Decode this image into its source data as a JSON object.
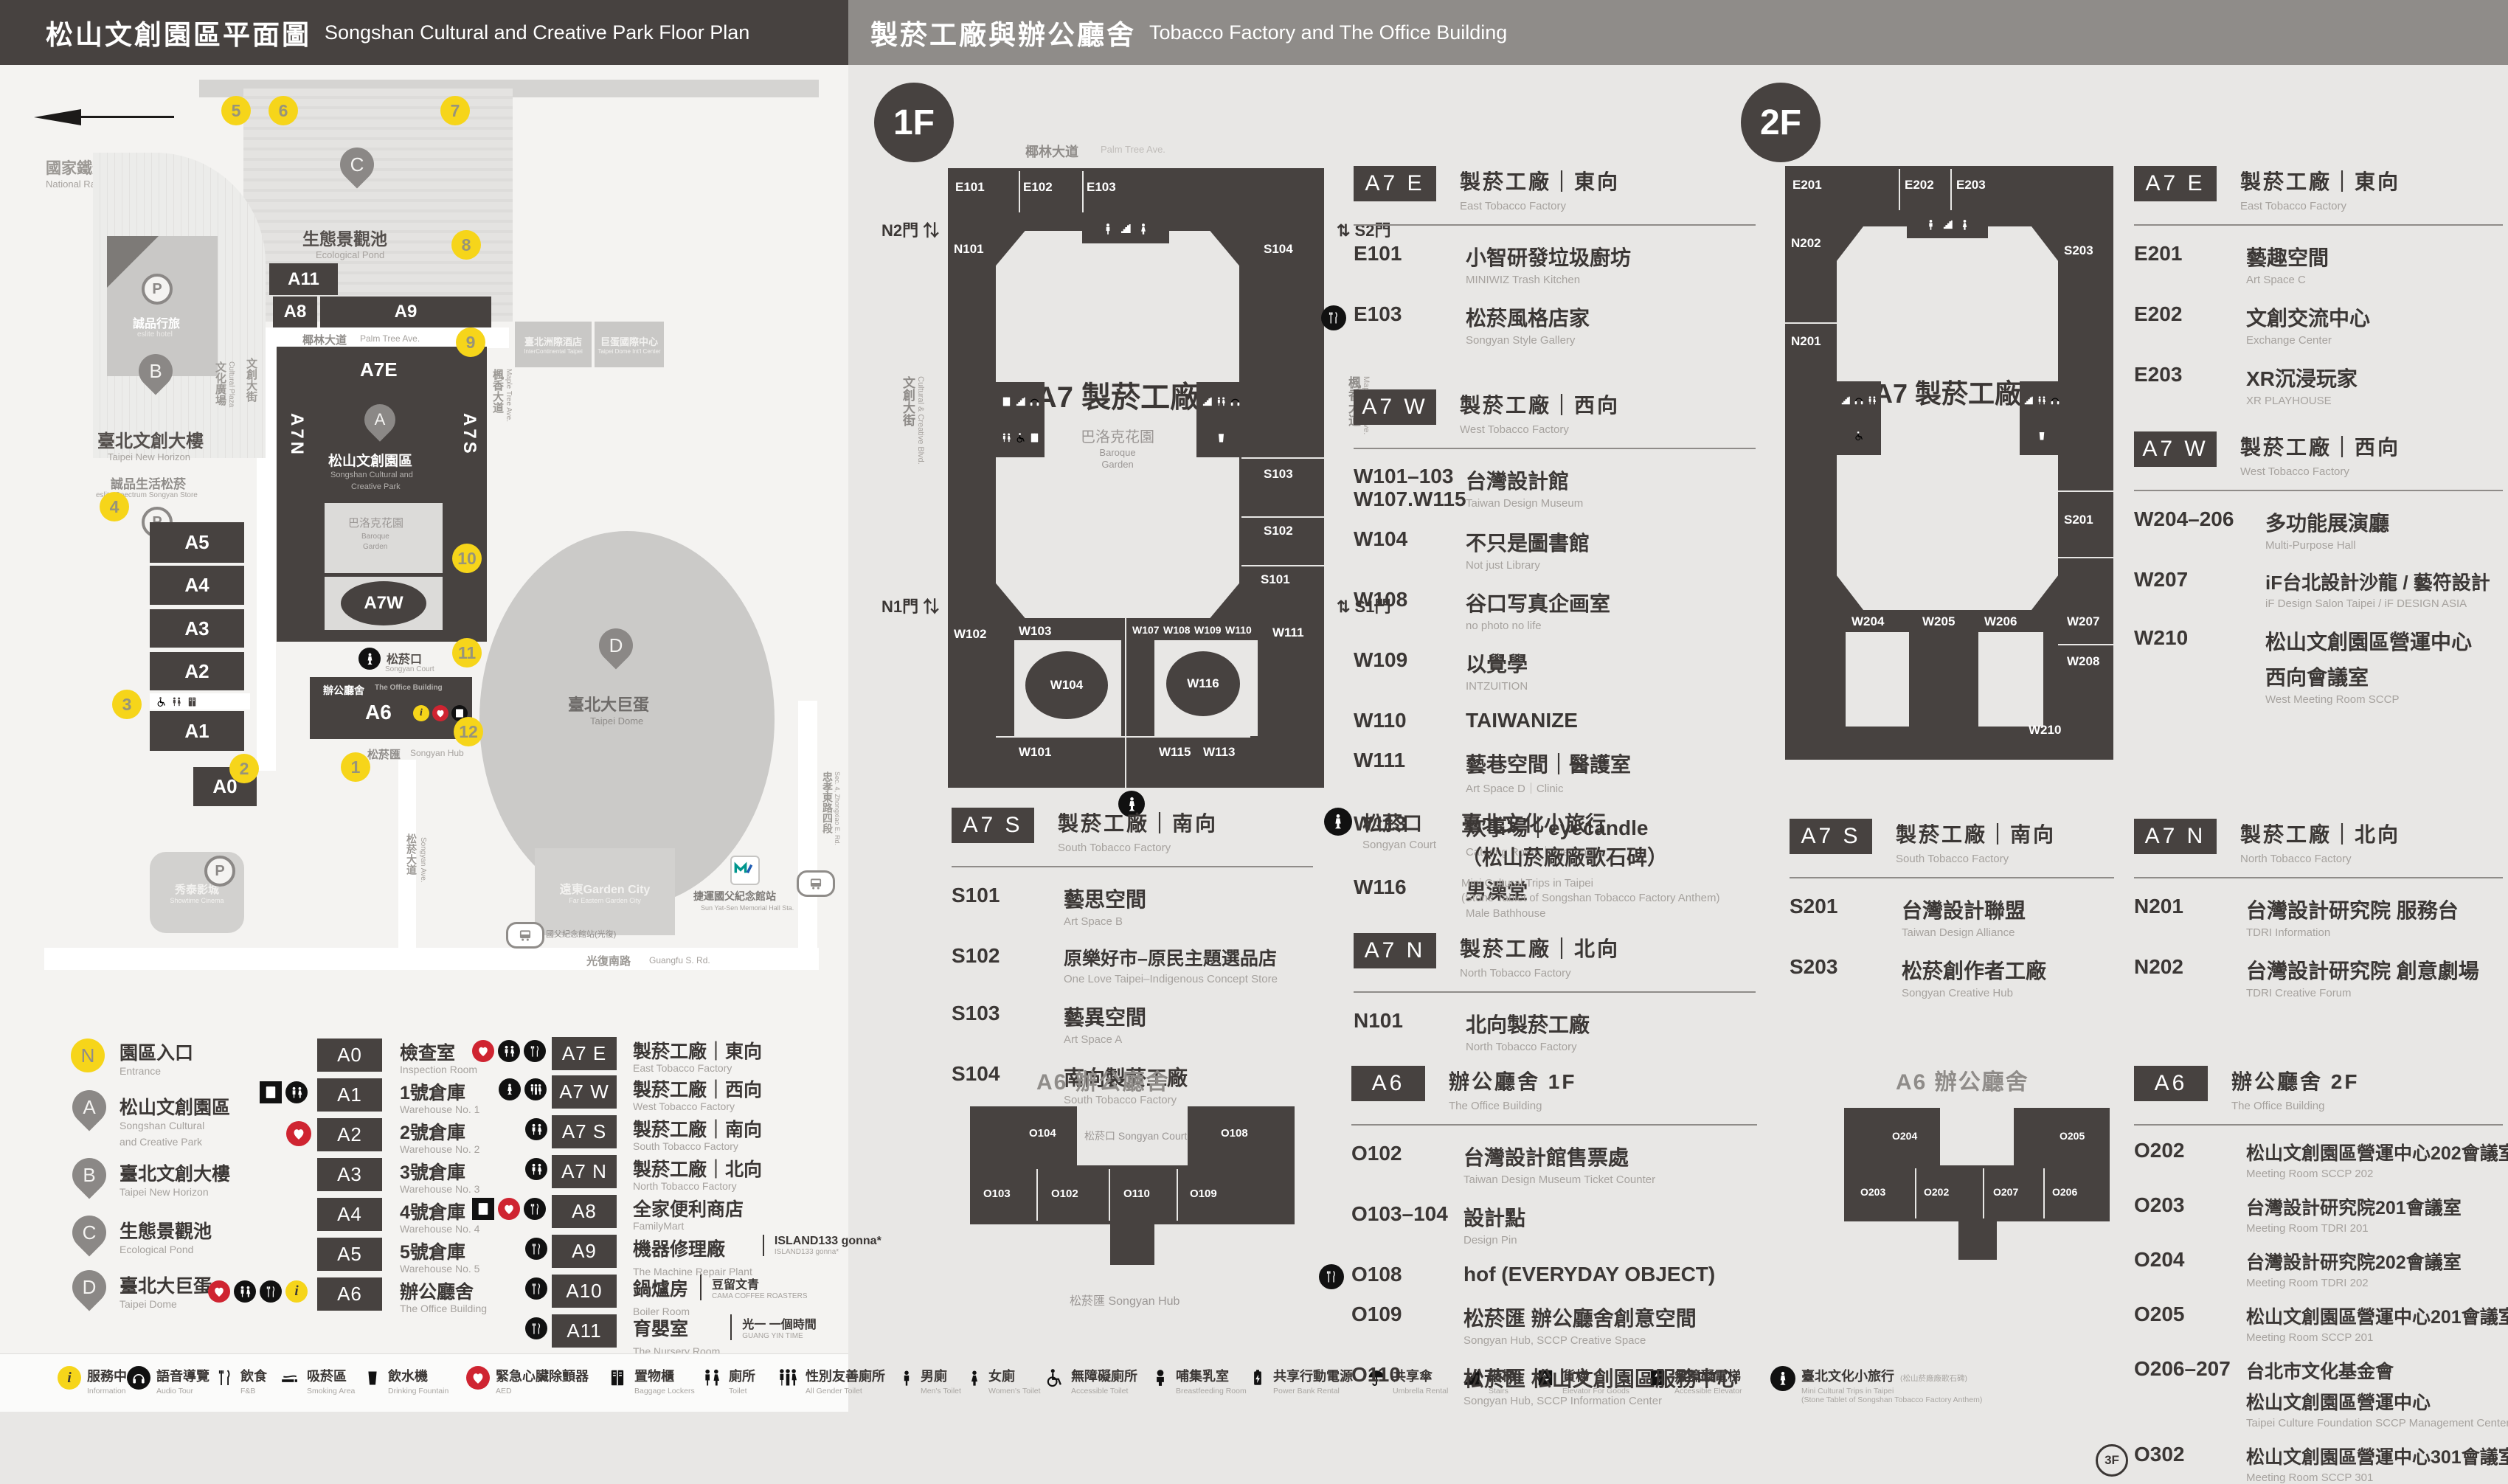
{
  "header": {
    "left_zh": "松山文創園區平面圖",
    "left_en": "Songshan Cultural and Creative Park Floor Plan",
    "right_zh": "製菸工廠與辦公廳舍",
    "right_en": "Tobacco Factory and The Office Building"
  },
  "map": {
    "railway_zh": "國家鐵道博物館",
    "railway_en": "National Railway Museum",
    "pond_zh": "生態景觀池",
    "pond_en": "Ecological Pond",
    "horizon_zh": "臺北文創大樓",
    "horizon_en": "Taipei New Horizon",
    "eslite_store_zh": "誠品生活松菸",
    "eslite_store_en": "eslite Spectrum Songyan Store",
    "eslite_hotel_zh": "誠品行旅",
    "eslite_hotel_en": "eslite hotel",
    "park_zh": "松山文創園區",
    "park_en1": "Songshan Cultural and",
    "park_en2": "Creative Park",
    "baroque_zh": "巴洛克花園",
    "baroque_en1": "Baroque",
    "baroque_en2": "Garden",
    "court_zh": "松菸口",
    "court_en": "Songyan Court",
    "office_zh": "辦公廳舍",
    "office_en": "The Office Building",
    "hub_zh": "松菸匯",
    "hub_en": "Songyan Hub",
    "dome_zh": "臺北大巨蛋",
    "dome_en": "Taipei Dome",
    "hotel2_zh": "臺北洲際酒店",
    "hotel2_en": "InterContinental Taipei",
    "domectr_zh": "巨蛋國際中心",
    "domectr_en": "Taipei Dome Int'l Center",
    "cinema_zh": "秀泰影城",
    "cinema_en": "Showtime Cinema",
    "garden_zh": "遠東Garden City",
    "garden_en": "Far Eastern Garden City",
    "mrt_zh": "捷運國父紀念館站",
    "mrt_en": "Sun Yat-Sen Memorial Hall Sta.",
    "bus_stop": "國父紀念館站(光復)",
    "palm_zh": "椰林大道",
    "palm_en": "Palm Tree Ave.",
    "plaza_zh": "文化廣場",
    "plaza_en": "Cultural Plaza",
    "blvd_zh": "文創大街",
    "blvd_en": "Cultural & Creative Blvd.",
    "maple_zh": "楓香大道",
    "maple_en": "Maple Tree Ave.",
    "songyan_ave_zh": "松菸大道",
    "songyan_ave_en": "Songyan Ave.",
    "guangfu_zh": "光復南路",
    "guangfu_en": "Guangfu S. Rd.",
    "zhongxiao_zh": "忠孝東路四段",
    "zhongxiao_en": "Sec. 4, Zhongxiao E. Rd.",
    "numbers": [
      "1",
      "2",
      "3",
      "4",
      "5",
      "6",
      "7",
      "8",
      "9",
      "10",
      "11",
      "12"
    ],
    "blocks": {
      "a0": "A0",
      "a1": "A1",
      "a2": "A2",
      "a3": "A3",
      "a4": "A4",
      "a5": "A5",
      "a6": "A6",
      "a7e": "A7E",
      "a7w": "A7W",
      "a7n": "A7N",
      "a7s": "A7S",
      "a8": "A8",
      "a9": "A9",
      "a10": "A10",
      "a11": "A11"
    }
  },
  "legend": {
    "entrance": {
      "badge": "N",
      "zh": "園區入口",
      "en": "Entrance"
    },
    "pins": [
      {
        "id": "A",
        "zh": "松山文創園區",
        "en1": "Songshan Cultural",
        "en2": "and Creative Park"
      },
      {
        "id": "B",
        "zh": "臺北文創大樓",
        "en1": "Taipei New Horizon",
        "en2": ""
      },
      {
        "id": "C",
        "zh": "生態景觀池",
        "en1": "Ecological Pond",
        "en2": ""
      },
      {
        "id": "D",
        "zh": "臺北大巨蛋",
        "en1": "Taipei Dome",
        "en2": ""
      }
    ],
    "colA": [
      {
        "code": "A0",
        "zh": "檢查室",
        "en": "Inspection Room",
        "icons": []
      },
      {
        "code": "A1",
        "zh": "1號倉庫",
        "en": "Warehouse No. 1",
        "icons": [
          "locker",
          "toilet"
        ]
      },
      {
        "code": "A2",
        "zh": "2號倉庫",
        "en": "Warehouse No. 2",
        "icons": [
          "aed"
        ]
      },
      {
        "code": "A3",
        "zh": "3號倉庫",
        "en": "Warehouse No. 3",
        "icons": []
      },
      {
        "code": "A4",
        "zh": "4號倉庫",
        "en": "Warehouse No. 4",
        "icons": []
      },
      {
        "code": "A5",
        "zh": "5號倉庫",
        "en": "Warehouse No. 5",
        "icons": []
      },
      {
        "code": "A6",
        "zh": "辦公廳舍",
        "en": "The Office Building",
        "icons": [
          "aed",
          "toilet",
          "fnb",
          "info"
        ]
      }
    ],
    "colB": [
      {
        "code": "A7 E",
        "zh": "製菸工廠｜東向",
        "en": "East Tobacco Factory",
        "icons": [
          "aed",
          "toilet",
          "fnb"
        ]
      },
      {
        "code": "A7 W",
        "zh": "製菸工廠｜西向",
        "en": "West Tobacco Factory",
        "icons": [
          "statue",
          "toilet"
        ]
      },
      {
        "code": "A7 S",
        "zh": "製菸工廠｜南向",
        "en": "South Tobacco Factory",
        "icons": [
          "toilet"
        ]
      },
      {
        "code": "A7 N",
        "zh": "製菸工廠｜北向",
        "en": "North Tobacco Factory",
        "icons": [
          "toilet"
        ]
      },
      {
        "code": "A8",
        "zh": "全家便利商店",
        "en": "FamilyMart",
        "icons": [
          "locker",
          "aed",
          "fnb"
        ]
      },
      {
        "code": "A9",
        "zh": "機器修理廠",
        "brand": "ISLAND133 gonna*",
        "brand_sub": "ISLAND133 gonna*",
        "en": "The Machine Repair Plant",
        "icons": [
          "fnb"
        ]
      },
      {
        "code": "A10",
        "zh": "鍋爐房",
        "brand": "豆留文青",
        "brand_sub": "CAMA COFFEE ROASTERS",
        "en": "Boiler Room",
        "icons": [
          "fnb"
        ]
      },
      {
        "code": "A11",
        "zh": "育嬰室",
        "brand": "光一 一個時間",
        "brand_sub": "GUANG YIN TIME",
        "en": "The Nursery Room",
        "icons": [
          "fnb"
        ]
      }
    ]
  },
  "footer": [
    {
      "zh": "服務中心",
      "en": "Information"
    },
    {
      "zh": "語音導覽",
      "en": "Audio Tour"
    },
    {
      "zh": "飲食",
      "en": "F&B"
    },
    {
      "zh": "吸菸區",
      "en": "Smoking Area"
    },
    {
      "zh": "飲水機",
      "en": "Drinking Fountain"
    },
    {
      "zh": "緊急心臟除顫器",
      "en": "AED"
    },
    {
      "zh": "置物櫃",
      "en": "Baggage Lockers"
    },
    {
      "zh": "廁所",
      "en": "Toilet"
    },
    {
      "zh": "性別友善廁所",
      "en": "All Gender Toilet"
    },
    {
      "zh": "男廁",
      "en": "Men's Toilet"
    },
    {
      "zh": "女廁",
      "en": "Women's Toilet"
    },
    {
      "zh": "無障礙廁所",
      "en": "Accessible Toilet"
    },
    {
      "zh": "哺集乳室",
      "en": "Breastfeeding Room"
    },
    {
      "zh": "共享行動電源",
      "en": "Power Bank Rental"
    },
    {
      "zh": "共享傘",
      "en": "Umbrella Rental"
    },
    {
      "zh": "階梯",
      "en": "Stairs"
    },
    {
      "zh": "貨梯",
      "en": "Elevator For Goods"
    },
    {
      "zh": "無障礙電梯",
      "en": "Accessible Elevator"
    },
    {
      "zh": "臺北文化小旅行",
      "note": "(松山菸廠廠歌石碑)",
      "en": "Mini Cultural Trips in Taipei",
      "en2": "(Stone Tablet of Songshan Tobacco Factory Anthem)"
    }
  ],
  "floor1": {
    "badge": "1F",
    "plan": {
      "street_top_zh": "椰林大道",
      "street_top_en": "Palm Tree Ave.",
      "street_left_zh": "文創大街",
      "street_left_en": "Cultural & Creative Blvd.",
      "street_right_zh": "楓香大道",
      "street_right_en": "Maple Tree Ave.",
      "n2": "N2門",
      "s2": "S2門",
      "n1": "N1門",
      "s1": "S1門",
      "center": "A7 製菸工廠",
      "garden_zh": "巴洛克花園",
      "garden_en1": "Baroque",
      "garden_en2": "Garden",
      "rooms": {
        "e101": "E101",
        "e102": "E102",
        "e103": "E103",
        "n101": "N101",
        "s101": "S101",
        "s102": "S102",
        "s103": "S103",
        "s104": "S104",
        "w101": "W101",
        "w102": "W102",
        "w103": "W103",
        "w104": "W104",
        "w107": "W107",
        "w108": "W108",
        "w109": "W109",
        "w110": "W110",
        "w111": "W111",
        "w113": "W113",
        "w115": "W115",
        "w116": "W116"
      }
    },
    "a7e": {
      "chip": "A7 E",
      "zh": "製菸工廠｜東向",
      "en": "East Tobacco Factory",
      "rooms": [
        {
          "code": "E101",
          "zh": "小智研發垃圾廚坊",
          "en": "MINIWIZ Trash Kitchen"
        },
        {
          "code": "E103",
          "zh": "松菸風格店家",
          "en": "Songyan Style Gallery"
        }
      ]
    },
    "a7w": {
      "chip": "A7 W",
      "zh": "製菸工廠｜西向",
      "en": "West Tobacco Factory",
      "rooms": [
        {
          "code": "W101–103",
          "code2": "W107.W115",
          "zh": "台灣設計館",
          "en": "Taiwan Design Museum"
        },
        {
          "code": "W104",
          "zh": "不只是圖書館",
          "en": "Not just Library"
        },
        {
          "code": "W108",
          "zh": "谷口写真企画室",
          "en": "no photo no life"
        },
        {
          "code": "W109",
          "zh": "以覺學",
          "en": "INTZUITION"
        },
        {
          "code": "W110",
          "zh": "TAIWANIZE",
          "en": ""
        },
        {
          "code": "W111",
          "zh": "藝巷空間｜醫護室",
          "en": "Art Space D｜Clinic"
        },
        {
          "code": "W113",
          "zh": "炊事場｜eyecandle",
          "en": "Catering Room｜eyecandle"
        },
        {
          "code": "W116",
          "zh": "男澡堂",
          "en": "Male Bathhouse"
        }
      ]
    },
    "a7s": {
      "chip": "A7 S",
      "zh": "製菸工廠｜南向",
      "en": "South Tobacco Factory",
      "rooms": [
        {
          "code": "S101",
          "zh": "藝思空間",
          "en": "Art Space B"
        },
        {
          "code": "S102",
          "zh": "原樂好市–原民主題選品店",
          "en": "One Love Taipei–Indigenous Concept Store"
        },
        {
          "code": "S103",
          "zh": "藝異空間",
          "en": "Art Space A"
        },
        {
          "code": "S104",
          "zh": "南向製菸工廠",
          "en": "South Tobacco Factory"
        }
      ]
    },
    "court": {
      "zh": "松菸口",
      "en": "Songyan Court",
      "t1": "臺北文化小旅行",
      "t2": "（松山菸廠廠歌石碑）",
      "e1": "Mini Cultural Trips in Taipei",
      "e2": "(Stone Tablet of Songshan Tobacco Factory Anthem)"
    },
    "a7n": {
      "chip": "A7 N",
      "zh": "製菸工廠｜北向",
      "en": "North Tobacco Factory",
      "rooms": [
        {
          "code": "N101",
          "zh": "北向製菸工廠",
          "en": "North Tobacco Factory"
        }
      ]
    },
    "a6": {
      "chip": "A6",
      "zh": "辦公廳舍  1F",
      "en": "The Office Building",
      "plan_title": "A6 辦公廳舍",
      "court_zh": "松菸口",
      "court_en": "Songyan Court",
      "hub_zh": "松菸匯",
      "hub_en": "Songyan Hub",
      "pr": {
        "o104": "O104",
        "o103": "O103",
        "o102": "O102",
        "o110": "O110",
        "o109": "O109",
        "o108": "O108"
      },
      "rooms": [
        {
          "code": "O102",
          "zh": "台灣設計館售票處",
          "en": "Taiwan Design Museum Ticket Counter"
        },
        {
          "code": "O103–104",
          "zh": "設計點",
          "en": "Design Pin"
        },
        {
          "code": "O108",
          "zh": "hof (EVERYDAY OBJECT)",
          "en": ""
        },
        {
          "code": "O109",
          "zh": "松菸匯 辦公廳舍創意空間",
          "en": "Songyan Hub, SCCP Creative Space"
        },
        {
          "code": "O110",
          "zh": "松菸匯 松山文創園區服務中心",
          "en": "Songyan Hub, SCCP Information Center"
        }
      ]
    }
  },
  "floor2": {
    "badge": "2F",
    "plan": {
      "center": "A7 製菸工廠",
      "rooms": {
        "e201": "E201",
        "e202": "E202",
        "e203": "E203",
        "n201": "N201",
        "n202": "N202",
        "s201": "S201",
        "s203": "S203",
        "w204": "W204",
        "w205": "W205",
        "w206": "W206",
        "w207": "W207",
        "w208": "W208",
        "w210": "W210"
      }
    },
    "a7e": {
      "chip": "A7 E",
      "zh": "製菸工廠｜東向",
      "en": "East Tobacco Factory",
      "rooms": [
        {
          "code": "E201",
          "zh": "藝趣空間",
          "en": "Art Space C"
        },
        {
          "code": "E202",
          "zh": "文創交流中心",
          "en": "Exchange Center"
        },
        {
          "code": "E203",
          "zh": "XR沉浸玩家",
          "en": "XR PLAYHOUSE"
        }
      ]
    },
    "a7w": {
      "chip": "A7 W",
      "zh": "製菸工廠｜西向",
      "en": "West Tobacco Factory",
      "rooms": [
        {
          "code": "W204–206",
          "zh": "多功能展演廳",
          "en": "Multi-Purpose Hall"
        },
        {
          "code": "W207",
          "zh": "iF台北設計沙龍 / 藝符設計",
          "en": "iF Design Salon Taipei / iF DESIGN ASIA"
        },
        {
          "code": "W210",
          "zh": "松山文創園區營運中心",
          "zh2": "西向會議室",
          "en": "West Meeting Room SCCP"
        }
      ]
    },
    "a7s": {
      "chip": "A7 S",
      "zh": "製菸工廠｜南向",
      "en": "South Tobacco Factory",
      "rooms": [
        {
          "code": "S201",
          "zh": "台灣設計聯盟",
          "en": "Taiwan Design Alliance"
        },
        {
          "code": "S203",
          "zh": "松菸創作者工廠",
          "en": "Songyan Creative Hub"
        }
      ]
    },
    "a7n": {
      "chip": "A7 N",
      "zh": "製菸工廠｜北向",
      "en": "North Tobacco Factory",
      "rooms": [
        {
          "code": "N201",
          "zh": "台灣設計研究院 服務台",
          "en": "TDRI Information"
        },
        {
          "code": "N202",
          "zh": "台灣設計研究院 創意劇場",
          "en": "TDRI Creative Forum"
        }
      ]
    },
    "a6": {
      "chip": "A6",
      "zh": "辦公廳舍  2F",
      "en": "The Office Building",
      "plan_title": "A6 辦公廳舍",
      "pr": {
        "o204": "O204",
        "o203": "O203",
        "o202": "O202",
        "o207": "O207",
        "o206": "O206",
        "o205": "O205"
      },
      "rooms": [
        {
          "code": "O202",
          "zh": "松山文創園區營運中心202會議室",
          "en": "Meeting Room SCCP 202"
        },
        {
          "code": "O203",
          "zh": "台灣設計研究院201會議室",
          "en": "Meeting Room TDRI 201"
        },
        {
          "code": "O204",
          "zh": "台灣設計研究院202會議室",
          "en": "Meeting Room TDRI 202"
        },
        {
          "code": "O205",
          "zh": "松山文創園區營運中心201會議室",
          "en": "Meeting Room SCCP 201"
        },
        {
          "code": "O206–207",
          "zh": "台北市文化基金會",
          "zh2": "松山文創園區營運中心",
          "en": "Taipei Culture Foundation SCCP Management Center"
        },
        {
          "code": "O302",
          "badge": "3F",
          "zh": "松山文創園區營運中心301會議室",
          "en": "Meeting Room SCCP 301"
        }
      ]
    }
  }
}
